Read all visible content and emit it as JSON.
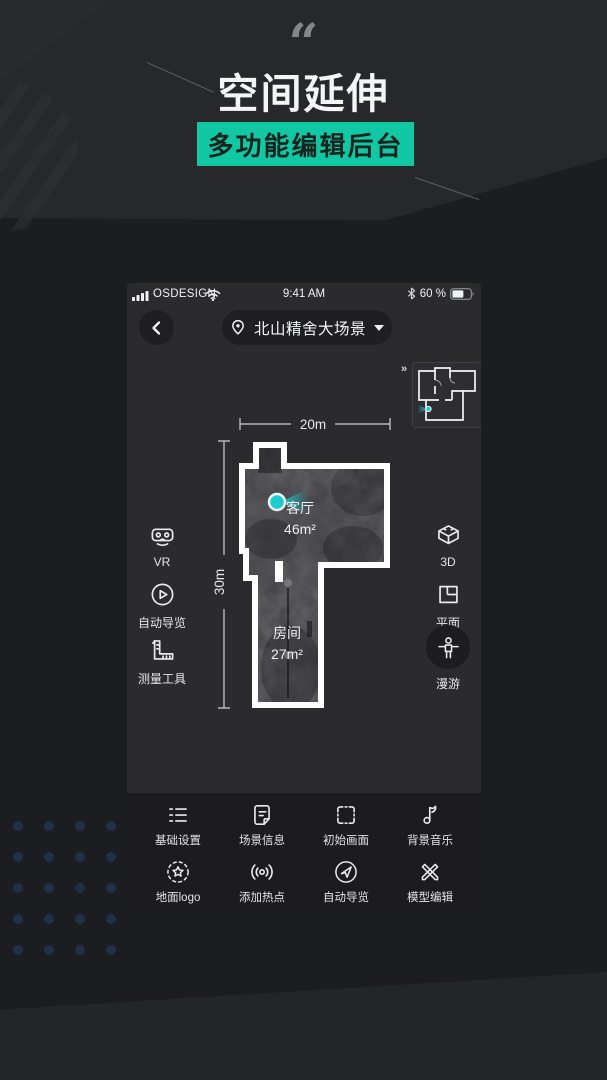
{
  "hero": {
    "quote_mark": "“",
    "title": "空间延伸",
    "badge_label": "多功能编辑后台"
  },
  "phone": {
    "status_bar": {
      "carrier": "OSDESIGN",
      "time": "9:41 AM",
      "battery_percent": "60 %"
    },
    "nav": {
      "scene_title": "北山精舍大场景"
    },
    "minimap": {
      "expand_label": "»"
    },
    "floor_plan": {
      "width_label": "20m",
      "height_label": "30m",
      "rooms": [
        {
          "name": "客厅",
          "area": "46m²"
        },
        {
          "name": "房间",
          "area": "27m²"
        }
      ]
    },
    "left_tools": [
      {
        "label": "VR"
      },
      {
        "label": "自动导览"
      },
      {
        "label": "测量工具"
      }
    ],
    "right_tools": [
      {
        "label": "3D"
      },
      {
        "label": "平面"
      },
      {
        "label": "漫游"
      }
    ],
    "toolbar": [
      {
        "label": "基础设置"
      },
      {
        "label": "场景信息"
      },
      {
        "label": "初始画面"
      },
      {
        "label": "背景音乐"
      },
      {
        "label": "地面logo"
      },
      {
        "label": "添加热点"
      },
      {
        "label": "自动导览"
      },
      {
        "label": "模型编辑"
      }
    ]
  },
  "colors": {
    "accent_teal": "#12c7a3",
    "marker_cyan": "#1dcbd0"
  }
}
